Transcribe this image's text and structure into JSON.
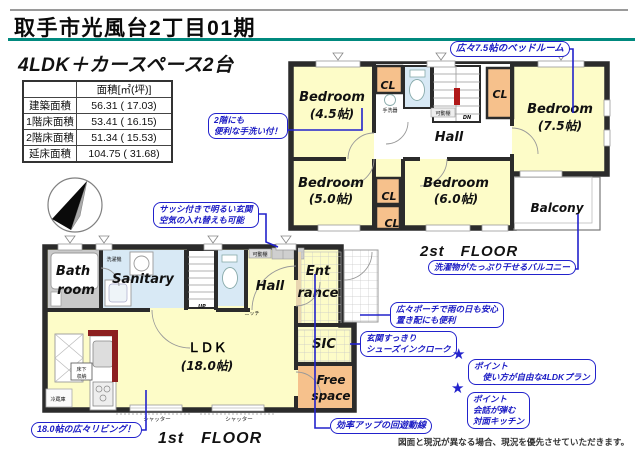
{
  "page": {
    "title": "取手市光風台2丁目01期",
    "subtitle": "4LDK＋カースペース2台",
    "disclaimer": "図面と現況が異なる場合、現況を優先させていただきます。"
  },
  "area_table": {
    "header": "面積[㎡(坪)]",
    "rows": [
      {
        "label": "建築面積",
        "value": "56.31 ( 17.03)"
      },
      {
        "label": "1階床面積",
        "value": "53.41 ( 16.15)"
      },
      {
        "label": "2階床面積",
        "value": "51.34 ( 15.53)"
      },
      {
        "label": "延床面積",
        "value": "104.75 ( 31.68)"
      }
    ]
  },
  "floor2": {
    "name": "2st　FLOOR",
    "bedroom": "Bedroom",
    "b45": "(4.5帖)",
    "b75": "(7.5帖)",
    "b50": "(5.0帖)",
    "b60": "(6.0帖)",
    "hall": "Hall",
    "balcony": "Balcony",
    "cl": "CL",
    "tearai": "手洗器",
    "kadoudana": "可動棚",
    "dn": "DN"
  },
  "floor1": {
    "name": "1st　FLOOR",
    "bath1": "Bath",
    "bath2": "room",
    "sanitary": "Sanitary",
    "washer": "洗濯機",
    "hall": "Hall",
    "kadoudana": "可動棚",
    "niche": "ニッチ",
    "up": "UP",
    "ent1": "Ent",
    "ent2": "rance",
    "ldk": "ＬＤＫ",
    "ldk_size": "(18.0帖)",
    "sic": "SIC",
    "free1": "Free",
    "free2": "space",
    "yukashita1": "床下",
    "yukashita2": "収納",
    "fridge": "冷蔵庫",
    "shutter": "シャッター"
  },
  "callouts": {
    "bedroom75": "広々7.5帖のベッドルーム",
    "tearai1": "2階にも",
    "tearai2": "便利な手洗い付！",
    "sash1": "サッシ付きで明るい玄関",
    "sash2": "空気の入れ替えも可能",
    "balcony": "洗濯物がたっぷり干せるバルコニー",
    "porch1": "広々ポーチで雨の日も安心",
    "porch2": "置き配にも便利",
    "sic1": "玄関すっきり",
    "sic2": "シューズインクローク",
    "point_label": "ポイント",
    "point1": "　使い方が自由な4LDKプラン",
    "point2a": "会話が弾む",
    "point2b": "対面キッチン",
    "living": "18.0帖の広々リビング！",
    "circulation": "効率アップの回遊動線",
    "star": "★"
  },
  "colors": {
    "accent_teal": "#00897E",
    "callout_blue": "#2222CC",
    "wall": "#2B2B2B",
    "room_yellow": "#FDFCC8",
    "closet_orange": "#F6C18C",
    "water_blue": "#D8E9F5",
    "kitchen_red": "#8C1F1F"
  }
}
